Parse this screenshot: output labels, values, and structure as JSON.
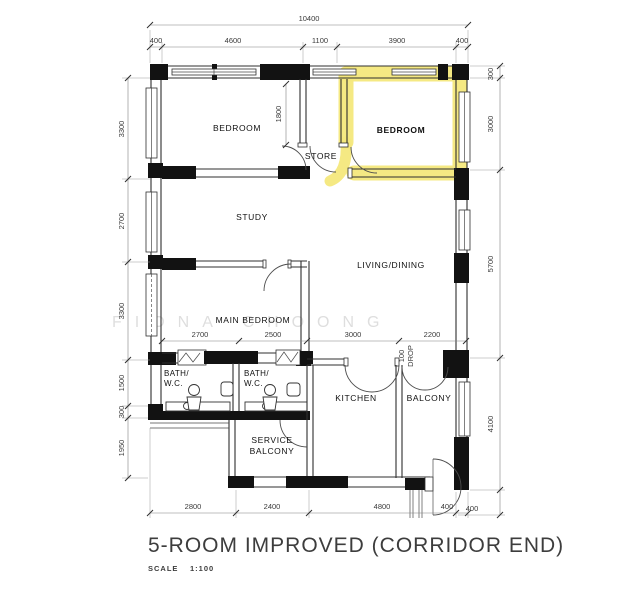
{
  "plan": {
    "title": "5-ROOM IMPROVED (CORRIDOR END)",
    "scale_label": "SCALE",
    "scale_value": "1:100",
    "watermark": "FIONA CHOONG",
    "highlight_color": "#f4e87c"
  },
  "rooms": {
    "bedroom_top_left": "BEDROOM",
    "store": "STORE",
    "bedroom_highlighted": "BEDROOM",
    "study": "STUDY",
    "living_dining": "LIVING/DINING",
    "main_bedroom": "MAIN BEDROOM",
    "bath1_line1": "BATH/",
    "bath1_line2": "W.C.",
    "bath2_line1": "BATH/",
    "bath2_line2": "W.C.",
    "kitchen": "KITCHEN",
    "balcony": "BALCONY",
    "service_balcony_line1": "SERVICE",
    "service_balcony_line2": "BALCONY"
  },
  "dims": {
    "overall_width": "10400",
    "top": [
      "400",
      "4600",
      "1100",
      "3900",
      "400"
    ],
    "left": [
      "3300",
      "2700",
      "3300",
      "1500",
      "300",
      "1950"
    ],
    "right": [
      "300",
      "3000",
      "5700",
      "4100",
      "400"
    ],
    "interior": [
      "2700",
      "2500",
      "3000",
      "2200"
    ],
    "bottom": [
      "2800",
      "2400",
      "4800",
      "400"
    ],
    "store_depth": "1800",
    "drop_line1": "100",
    "drop_line2": "DROP"
  }
}
